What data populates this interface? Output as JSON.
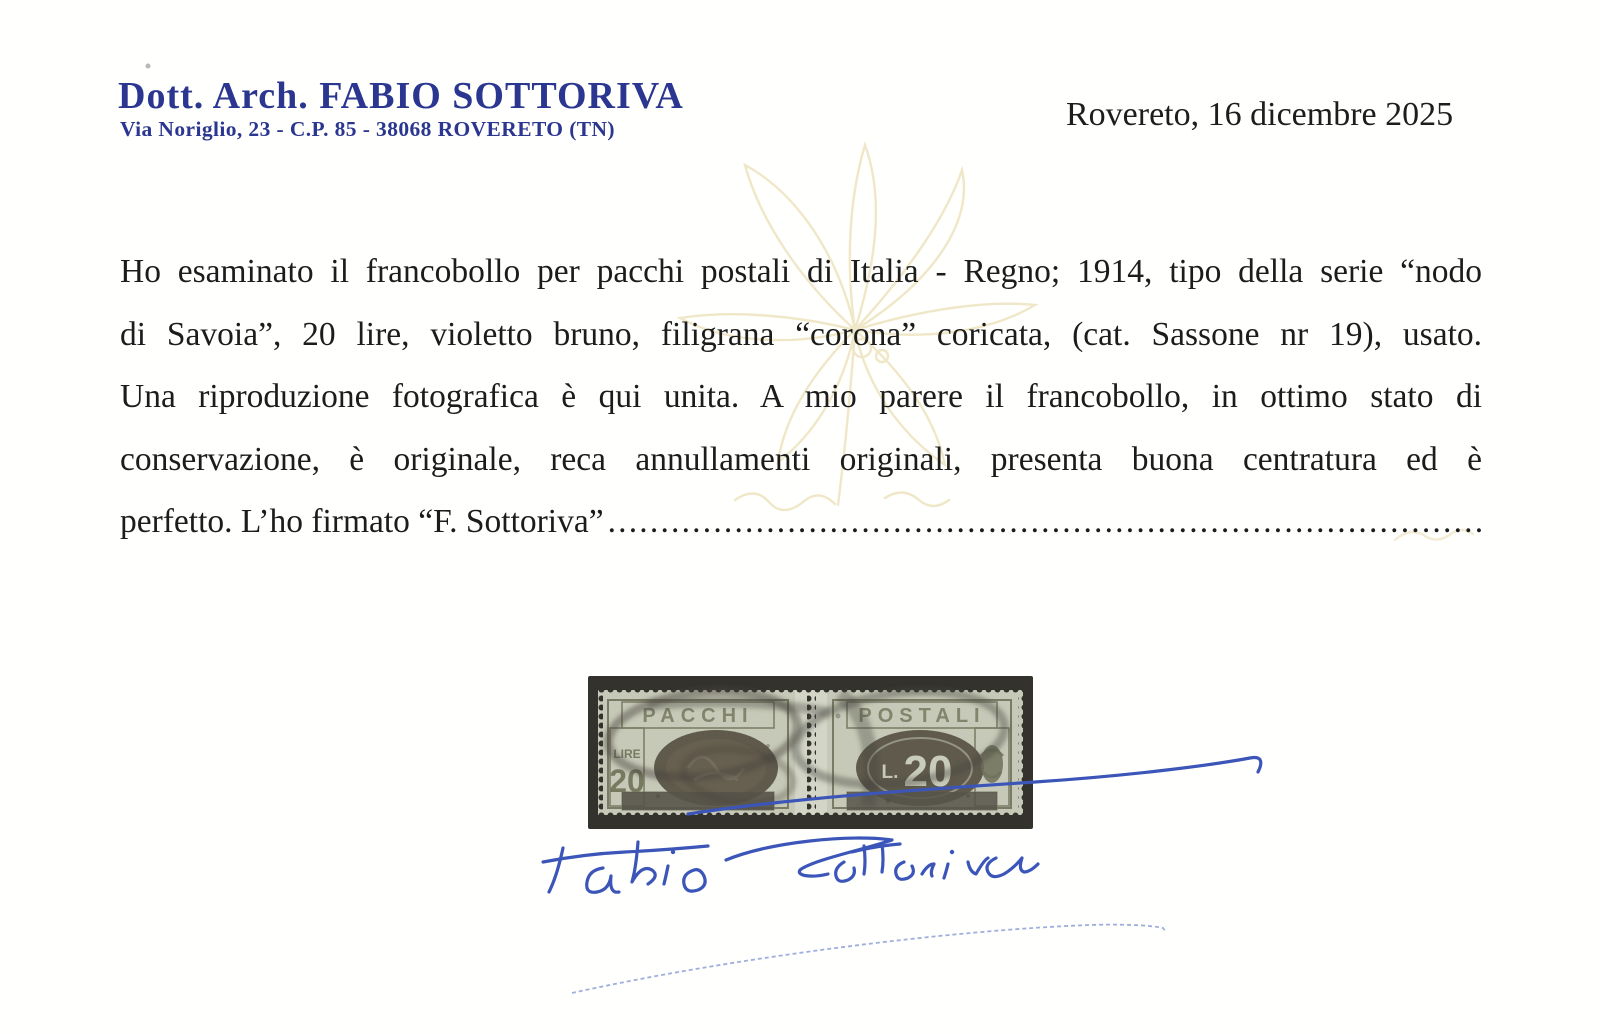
{
  "certifier": {
    "name": "Dott. Arch. FABIO SOTTORIVA",
    "address": "Via Noriglio, 23 - C.P. 85 - 38068 ROVERETO (TN)"
  },
  "dateline": "Rovereto, 16 dicembre 2025",
  "body": {
    "line1": "Ho esaminato il francobollo per pacchi postali di Italia - Regno; 1914, tipo della serie “nodo",
    "line2": "di Savoia”, 20 lire, violetto bruno, filigrana “corona” coricata, (cat. Sassone nr 19), usato.",
    "line3": "Una riproduzione fotografica è qui unita. A mio parere il francobollo, in ottimo stato di",
    "line4": "conservazione, è originale, reca annullamenti originali, presenta buona centratura ed è",
    "line5": "perfetto. L’ho firmato “F. Sottoriva”",
    "dot_leader": "........................................................................................................................"
  },
  "stamp": {
    "left_title": "PACCHI",
    "right_title": "POSTALI",
    "lire_label": "LIRE",
    "left_value": "20",
    "right_value_prefix": "L.",
    "right_value": "20"
  },
  "signature_name": "Fabio Sottoriva",
  "colors": {
    "header_blue": "#2b3690",
    "body_text": "#1c1c1c",
    "signature_ink": "#3b55b8",
    "watermark_yellow": "#efe6c4",
    "stamp_photo_bg": "#33322d",
    "stamp_paper": "#c6c9b7"
  }
}
